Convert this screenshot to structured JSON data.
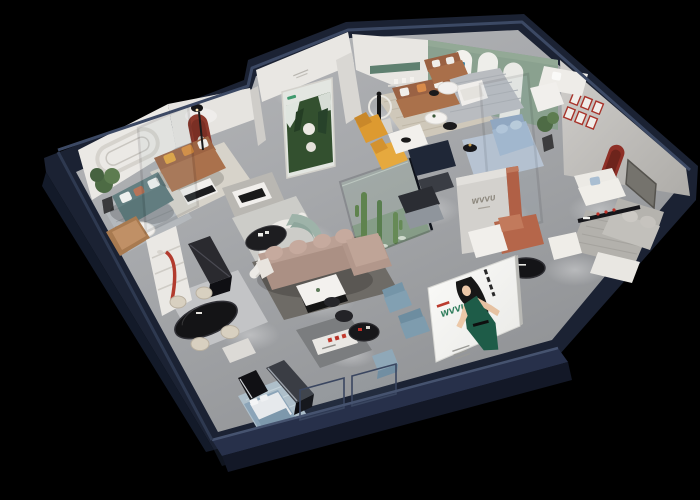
{
  "scene": {
    "title": "Furniture showroom 3D cutaway render",
    "background": "#000000",
    "style": "isometric perspective model, spotlit interiors, black surround",
    "palette": {
      "exterior_wall": "#1c2435",
      "exterior_wall_top": "#3c4964",
      "interior_wall": "#e9e7e3",
      "floor": "#a9abae",
      "accent_red": "#8e362a",
      "accent_terracotta": "#b4674c",
      "accent_amber": "#e4a23a",
      "accent_sage_wall": "#8aa18f",
      "sofa_teal": "#5d7a7c",
      "sofa_caramel": "#aa714c",
      "sofa_mauve": "#b39a8e",
      "sofa_blue": "#9fb4cc",
      "brand_green": "#2f7d5c"
    },
    "signage": {
      "brand_wall": {
        "logo": "WVVU"
      },
      "led_screen": {
        "logo": "WVVU",
        "figure": "illustrated hostess in green dress",
        "panel_color": "#f5f5f3"
      },
      "arch_badge": {
        "letter": "M"
      },
      "forest_poster": {
        "subject": "pine forest artwork with round product emblems"
      },
      "red_gallery": {
        "frames": 6
      }
    },
    "rooms": [
      {
        "name": "left-lounge",
        "furniture": [
          "teal fabric sofa",
          "potted plant",
          "round white coffee table",
          "tan leather bench",
          "striped grey rug",
          "stadium molding wall"
        ]
      },
      {
        "name": "caramel-sofa-room",
        "furniture": [
          "caramel leather sofa with amber pillows",
          "white coffee table",
          "black floor lamp",
          "red arched niche",
          "glass partition",
          "forest poster"
        ]
      },
      {
        "name": "center-lounge",
        "furniture": [
          "curved white partition",
          "sage curved sofa",
          "black oval coffee table",
          "mauve L-shaped sectional",
          "white and black coffee table",
          "dark grey rug"
        ]
      },
      {
        "name": "cactus-terrarium",
        "furniture": [
          "green glass enclosure",
          "cacti",
          "white pebbles"
        ]
      },
      {
        "name": "north-lounge",
        "furniture": [
          "caramel leather sofa",
          "white armchair",
          "round side tables",
          "ring lamp sculpture",
          "two amber chaise chairs",
          "striped beige rug",
          "green wall band"
        ]
      },
      {
        "name": "arch-gallery",
        "furniture": [
          "sage green wall",
          "three arched display cards",
          "white sofa",
          "white armchair",
          "glass partition",
          "powder blue sofa",
          "blue rug"
        ]
      },
      {
        "name": "east-suite",
        "furniture": [
          "red framed picture grid",
          "red arched niche",
          "recessed media panel",
          "white sofa with blue pillow",
          "grey sectional sofa",
          "wall shelf with red accents",
          "black round coffee table",
          "white ottoman",
          "striped rug",
          "potted plant"
        ]
      },
      {
        "name": "brand-hallway",
        "furniture": [
          "freestanding brand wall",
          "terracotta column",
          "terracotta bench with white cushions",
          "stainless kitchenette counters"
        ]
      },
      {
        "name": "dining-corner",
        "furniture": [
          "shelf niche with red tube sculpture",
          "black marble console",
          "black oval dining table",
          "four cream chairs",
          "grey rug"
        ]
      },
      {
        "name": "front-gallery",
        "furniture": [
          "black media benches",
          "white shelf with red lettering",
          "black round display table",
          "steel blue lounge chairs",
          "blue cube ottoman",
          "powder blue bed with white duvet",
          "patterned blue rug",
          "LED hostess screen",
          "front glass balustrade"
        ]
      }
    ]
  }
}
